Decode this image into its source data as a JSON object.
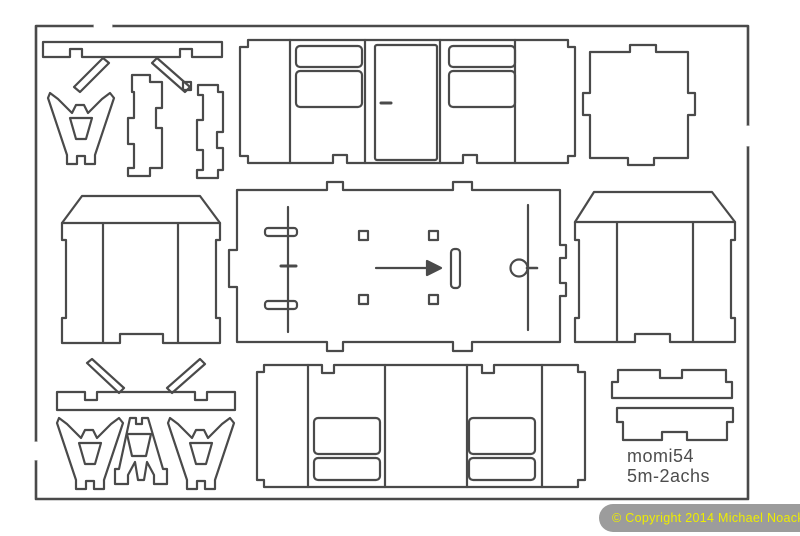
{
  "sheet": {
    "kit_label_line1": "momi54",
    "kit_label_line2": "5m-2achs",
    "line_color": "#4a4a4a",
    "label_color": "#4d4d4d",
    "background_color": "#ffffff"
  },
  "copyright": {
    "text": "© Copyright 2014 Michael Noack",
    "bar_color": "#9c9c9c",
    "text_color": "#eded00"
  }
}
